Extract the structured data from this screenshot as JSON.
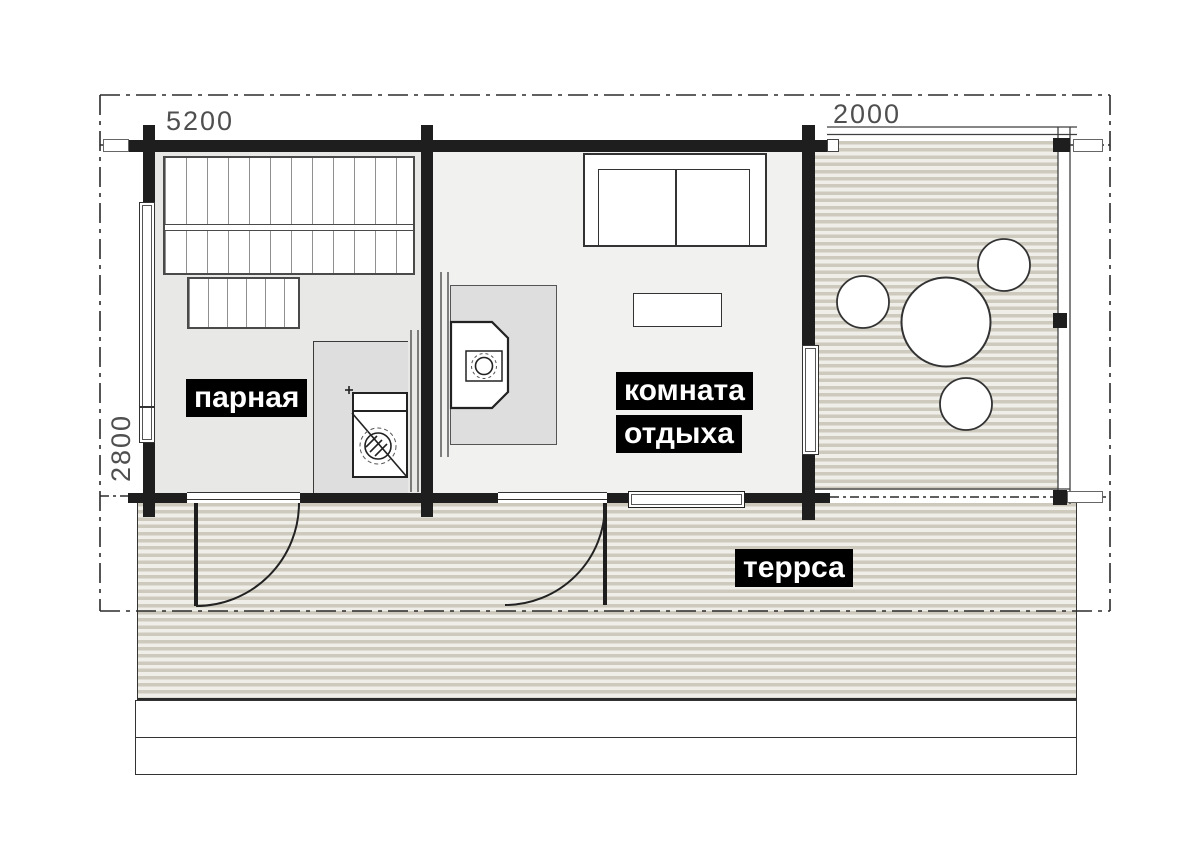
{
  "plan": {
    "title": "sauna floor plan",
    "dimensions": {
      "top_left": "5200",
      "top_right": "2000",
      "left": "2800"
    },
    "rooms": {
      "steam_room": {
        "label": "парная"
      },
      "lounge": {
        "label_line1": "комната",
        "label_line2": "отдыха"
      },
      "terrace": {
        "label": "террса"
      }
    },
    "colors": {
      "wall": "#1e1e1e",
      "steam_room_floor": "#e8e8e6",
      "lounge_floor": "#f1f1ef",
      "furniture_gray": "#dedede",
      "deck_stripe_dark": "#cdc9bd",
      "deck_stripe_light": "#efeee9",
      "label_bg": "#000000",
      "label_text": "#ffffff",
      "dimension_text": "#4f4f4f"
    }
  }
}
